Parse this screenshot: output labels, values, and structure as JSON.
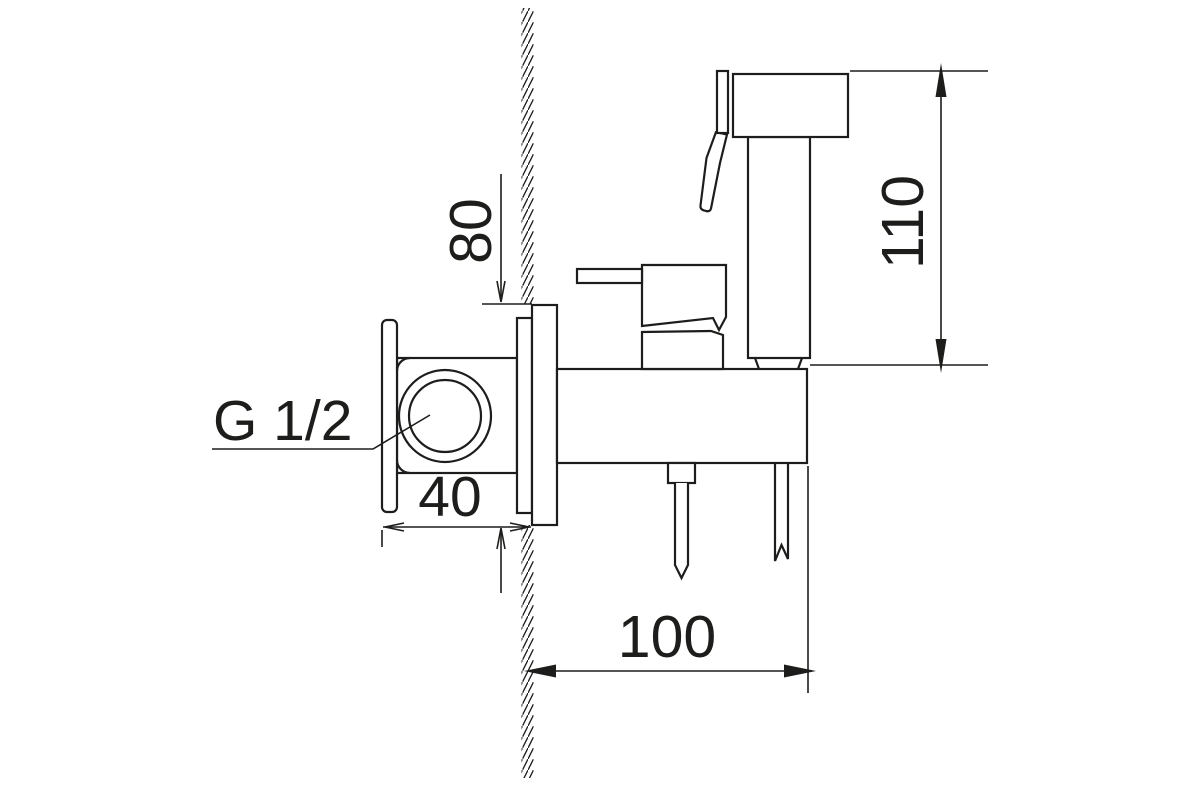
{
  "drawing": {
    "background_color": "#ffffff",
    "line_color": "#1d1d1b",
    "dimensions": {
      "plate_height": "80",
      "sprayer_height": "110",
      "wall_depth": "40",
      "body_length": "100"
    },
    "labels": {
      "thread_size": "G 1/2"
    }
  }
}
